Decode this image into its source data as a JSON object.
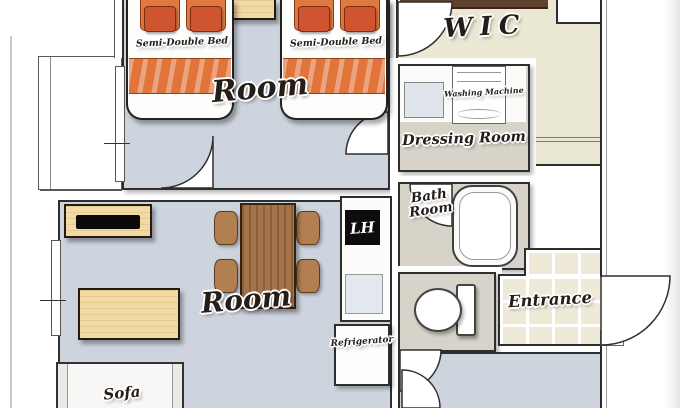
{
  "plan": {
    "rooms": {
      "bedroom": {
        "label": "Room"
      },
      "living_room": {
        "label": "Room"
      },
      "wic": {
        "label": "WIC"
      },
      "dressing_room": {
        "label": "Dressing Room"
      },
      "bath_room": {
        "line1": "Bath",
        "line2": "Room"
      },
      "entrance": {
        "label": "Entrance"
      }
    },
    "furniture": {
      "beds": [
        {
          "label": "Semi-Double Bed"
        },
        {
          "label": "Semi-Double Bed"
        }
      ],
      "washing_machine": {
        "label": "Washing Machine"
      },
      "refrigerator": {
        "label": "Refrigerator"
      },
      "sofa": {
        "label": "Sofa"
      },
      "kitchen_logo": {
        "label": "LH"
      }
    },
    "colors": {
      "floor_main": "#cdd4de",
      "floor_wic": "#eae7d3",
      "floor_wet_rooms": "#d8d3c9",
      "floor_entrance_tile": "#efead8",
      "wall_line": "#2e2e2e",
      "bed_blanket_orange": "#e0743a",
      "pillow_orange_red": "#cf5530",
      "wood_light": "#f2daa4",
      "wood_dark": "#a5744a"
    }
  }
}
